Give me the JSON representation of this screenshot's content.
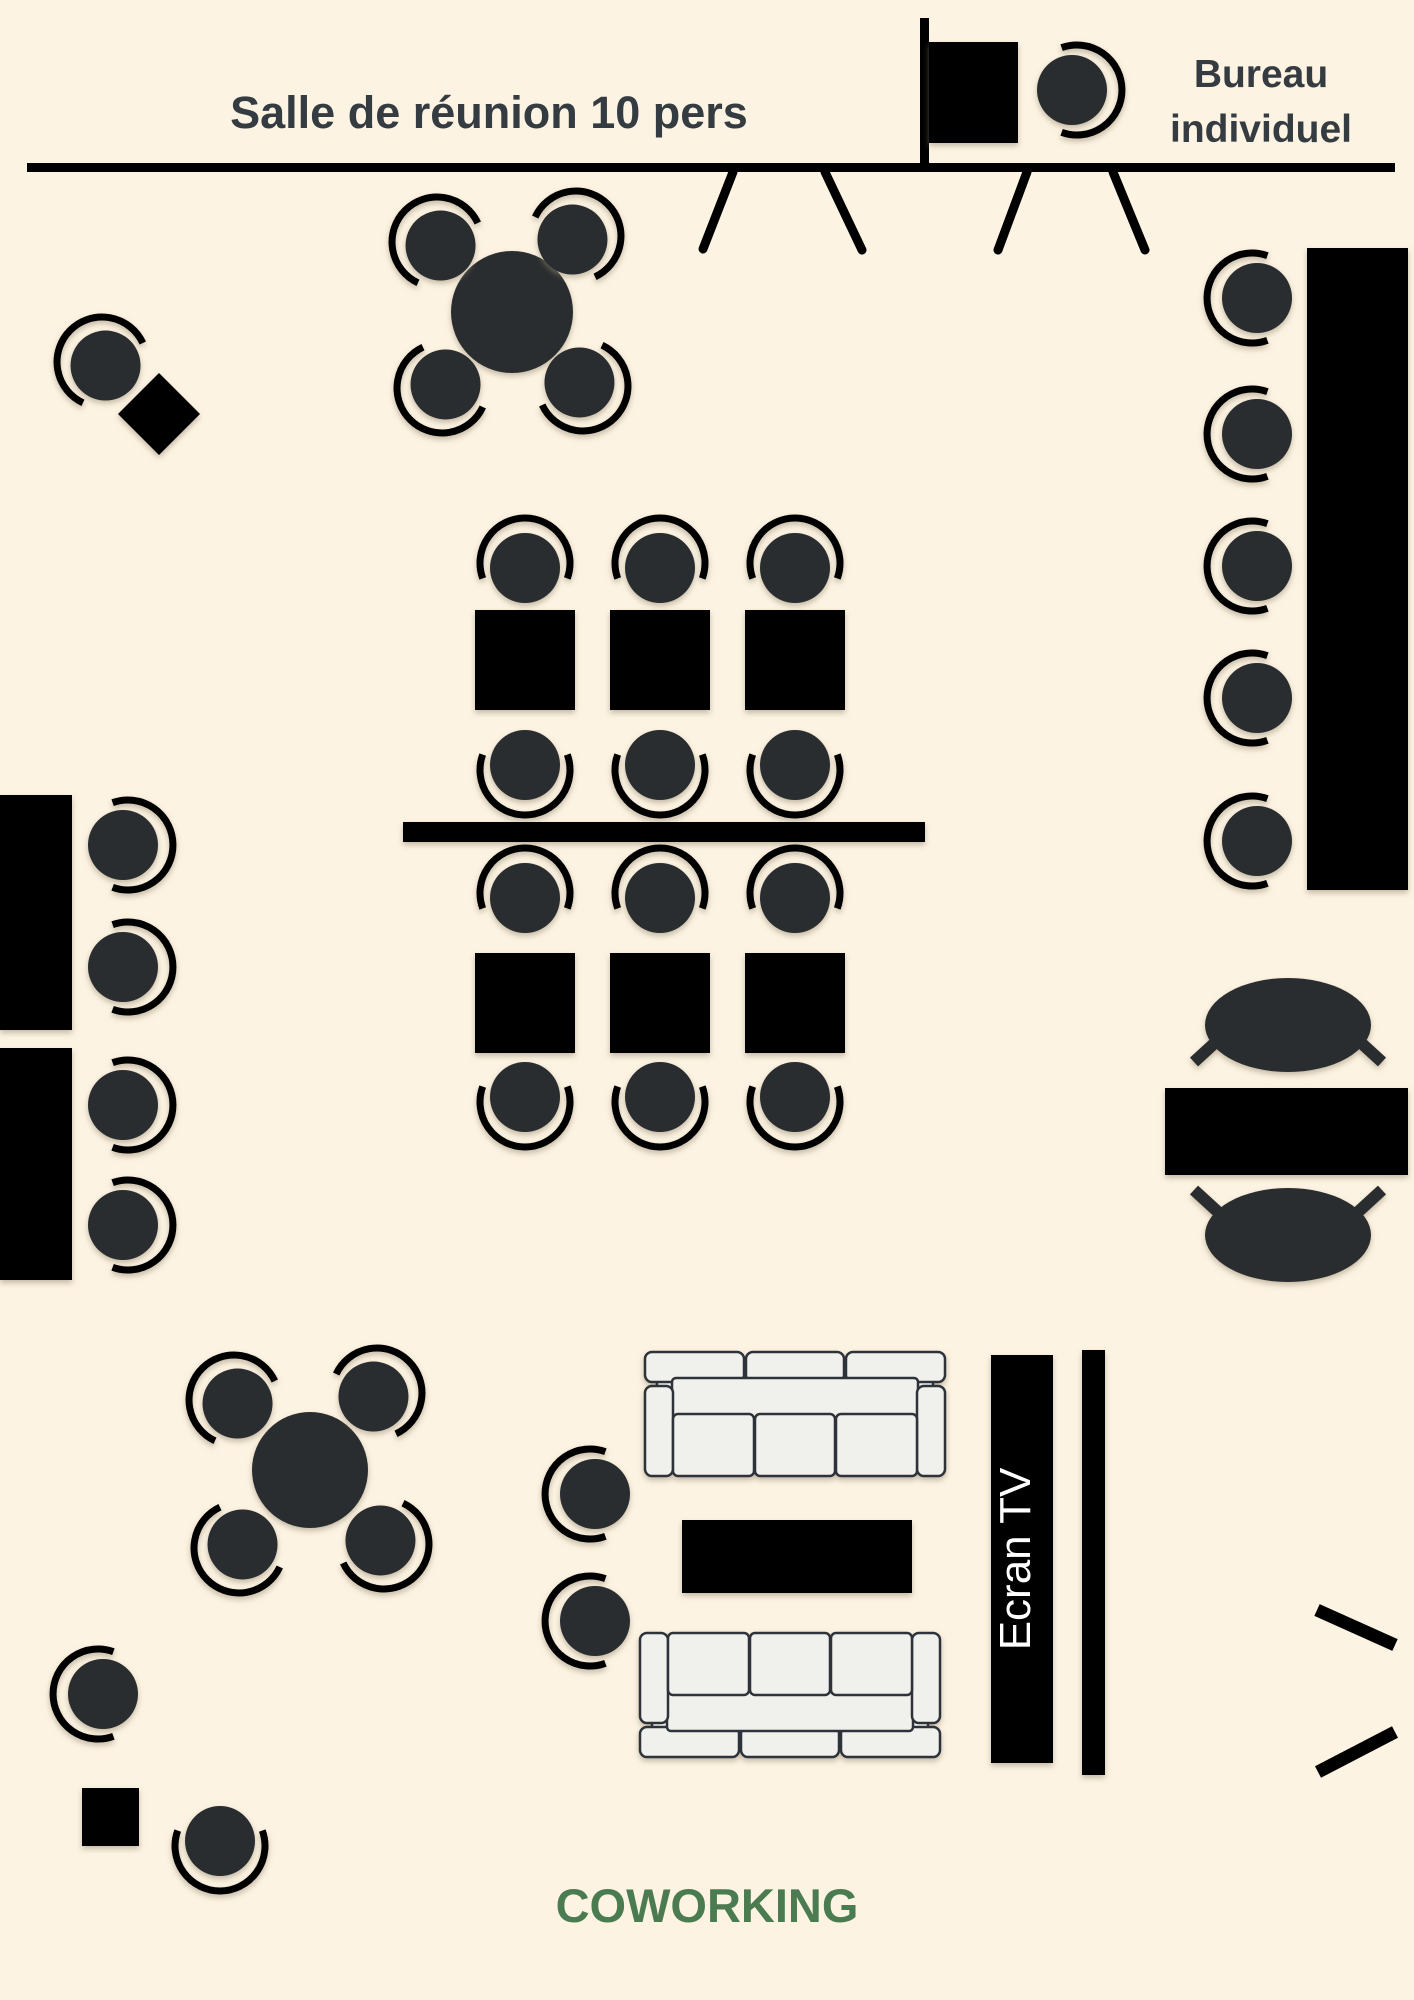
{
  "title": {
    "text": "Salle de réunion 10 pers"
  },
  "bureau": {
    "line1": "Bureau",
    "line2": "individuel"
  },
  "tv": {
    "label": "Ecran TV"
  },
  "footer": {
    "label": "COWORKING"
  },
  "colors": {
    "background": "#fdf3e2",
    "furniture-dark": "#2a2d2f",
    "black": "#000000",
    "sofa-fill": "#f0f0ec",
    "sofa-outline": "#2e333a",
    "tv-text": "#ffffff",
    "coworking-green": "#4b7b50",
    "title-text": "#343b41"
  }
}
